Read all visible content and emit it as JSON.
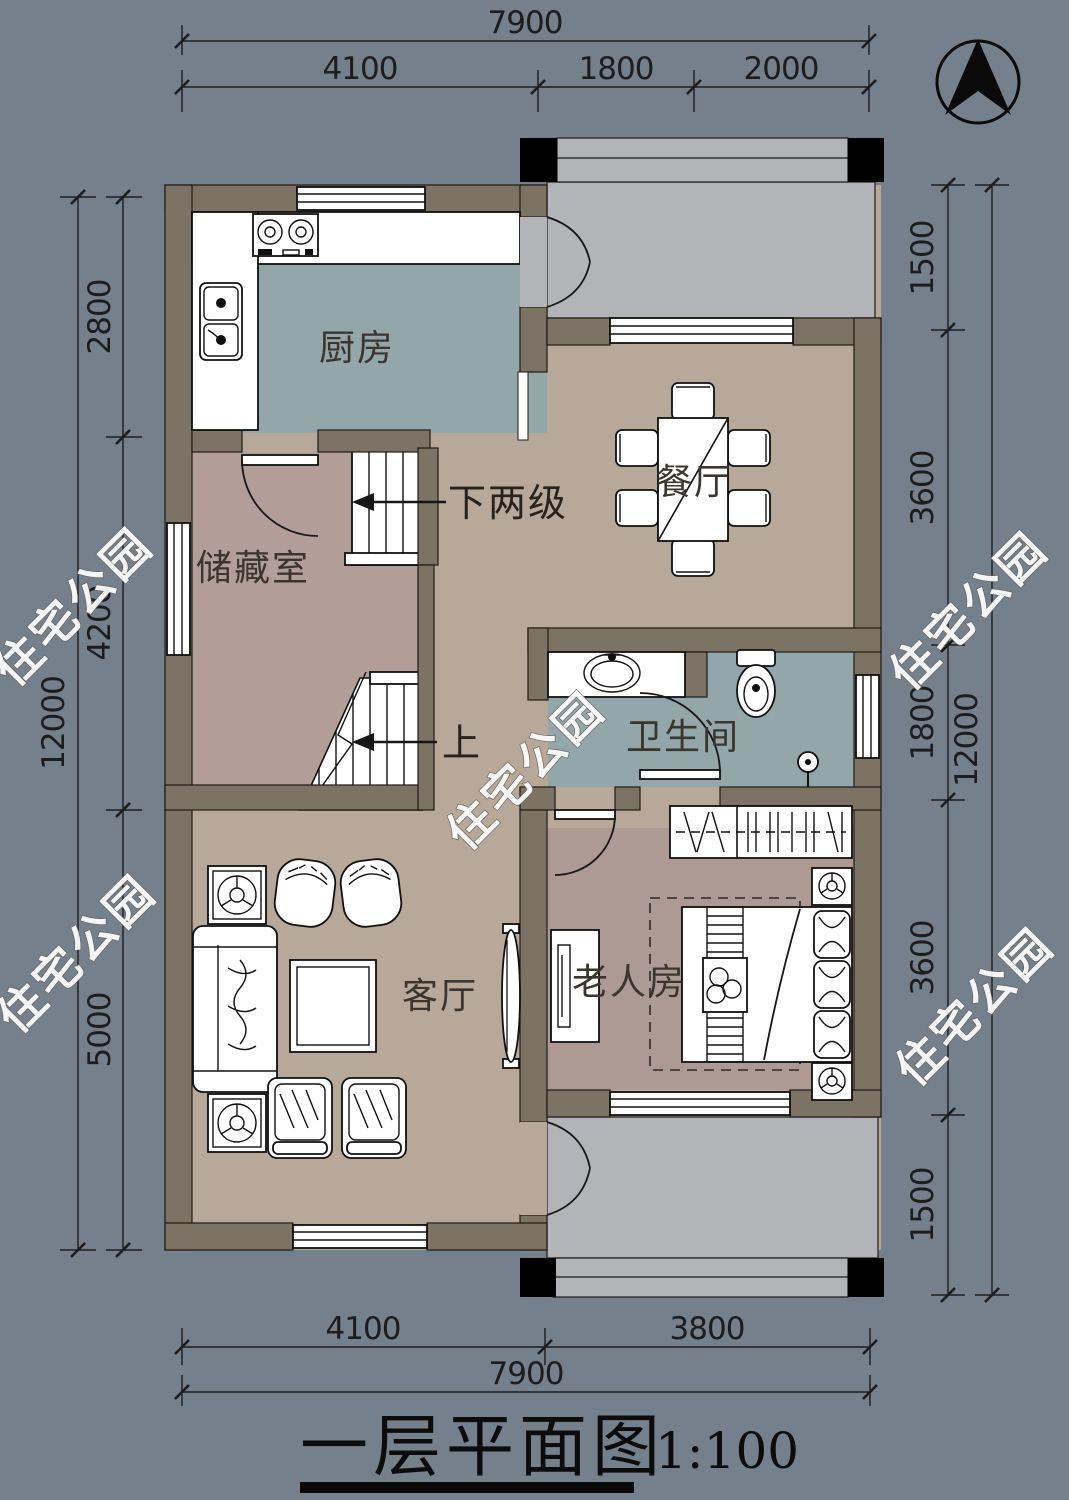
{
  "watermark": {
    "text": "住宅公园"
  },
  "compass": {
    "type": "north-arrow"
  },
  "title": {
    "main": "一层平面图",
    "scale": "1:100"
  },
  "rooms": {
    "kitchen": "厨房",
    "dining": "餐厅",
    "storage": "储藏室",
    "bathroom": "卫生间",
    "living": "客厅",
    "bedroom": "老人房"
  },
  "stairs": {
    "down_label": "下两级",
    "up_label": "上"
  },
  "dimensions": {
    "top": {
      "total": "7900",
      "segments": [
        "4100",
        "1800",
        "2000"
      ]
    },
    "bottom": {
      "total": "7900",
      "segments": [
        "4100",
        "3800"
      ]
    },
    "left": {
      "total": "12000",
      "segments": [
        "2800",
        "4200",
        "5000"
      ]
    },
    "right": {
      "total": "12000",
      "segments": [
        "1500",
        "3600",
        "1800",
        "3600",
        "1500"
      ]
    }
  },
  "colors": {
    "background": "#75808d",
    "wall": "#7d7365",
    "kitchen_bath_floor": "#93a6a9",
    "hall_floor": "#b7a899",
    "storage_floor": "#b29e97",
    "bedroom_floor": "#ad9a92",
    "porch_floor": "#b2b4b8",
    "furniture": "#ffffff",
    "line": "#1d1d1d"
  }
}
